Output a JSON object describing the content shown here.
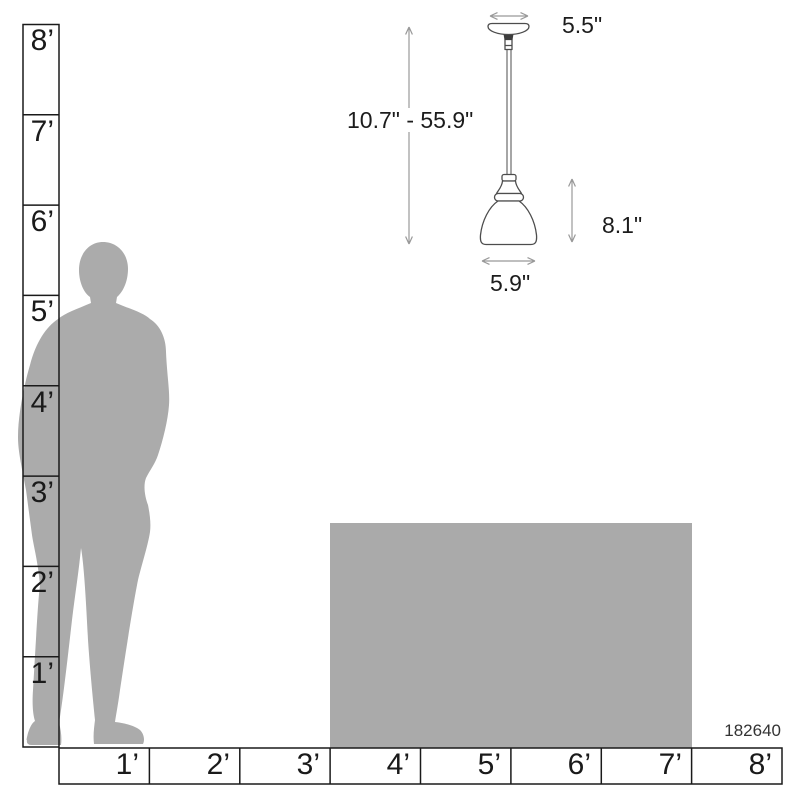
{
  "diagram": {
    "product_number": "182640",
    "pendant": {
      "canopy_width": "5.5\"",
      "height_range": "10.7\" - 55.9\"",
      "shade_height": "8.1\"",
      "shade_width": "5.9\""
    },
    "vertical_ruler_labels": [
      "8’",
      "7’",
      "6’",
      "5’",
      "4’",
      "3’",
      "2’",
      "1’"
    ],
    "horizontal_ruler_labels": [
      "1’",
      "2’",
      "3’",
      "4’",
      "5’",
      "6’",
      "7’",
      "8’"
    ],
    "colors": {
      "silhouette_gray": "#ABABAB",
      "furniture_gray": "#AAAAAA",
      "dimension_line_gray": "#999999",
      "ruler_line": "#1A1A1A",
      "label_text": "#1A1A1A",
      "drawing_outline": "#4D4D4D"
    }
  }
}
